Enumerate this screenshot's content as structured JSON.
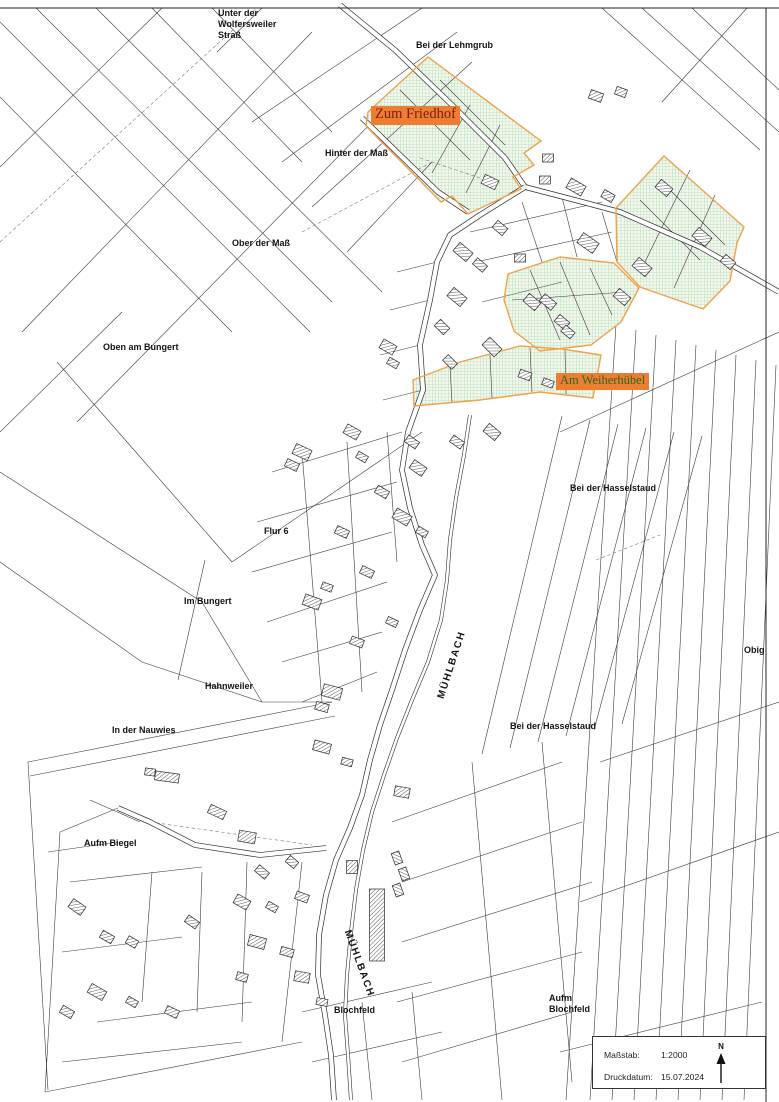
{
  "map": {
    "title": "Cadastral parcel map (Katasterkarte)",
    "colors": {
      "background": "#ffffff",
      "line": "#3c3c3c",
      "building": "#2b2b2b",
      "area_fill": "#f4f9f0",
      "area_grid": "#8cc88c",
      "area_border": "#f0a14b",
      "highlight_bg": "#ed7d31",
      "highlight_text_red": "#7b1c0f",
      "highlight_text_green": "#266b21"
    },
    "labels": [
      {
        "text": "Unter der\nWolfersweiler\nStraß"
      },
      {
        "text": "Bei der Lehmgrub"
      },
      {
        "text": "Hinter der Maß"
      },
      {
        "text": "Ober der Maß"
      },
      {
        "text": "Oben am Bungert"
      },
      {
        "text": "Bei der Hasselstaud"
      },
      {
        "text": "Flur 6"
      },
      {
        "text": "Im Bungert"
      },
      {
        "text": "Hahnweiler"
      },
      {
        "text": "In der Nauwies"
      },
      {
        "text": "Bei der Hasselstaud"
      },
      {
        "text": "Aufm Biegel"
      },
      {
        "text": "Blochfeld"
      },
      {
        "text": "Aufm\nBlochfeld"
      },
      {
        "text": "Obig"
      },
      {
        "text": "MÜHLBACH"
      },
      {
        "text": "MÜHLBACH"
      }
    ],
    "highlighted": [
      {
        "text": "Zum Friedhof"
      },
      {
        "text": "Am Weiherhübel"
      }
    ]
  },
  "legend": {
    "scale_label": "Maßstab:",
    "scale_value": "1:2000",
    "date_label": "Druckdatum:",
    "date_value": "15.07.2024",
    "north_label": "N"
  }
}
